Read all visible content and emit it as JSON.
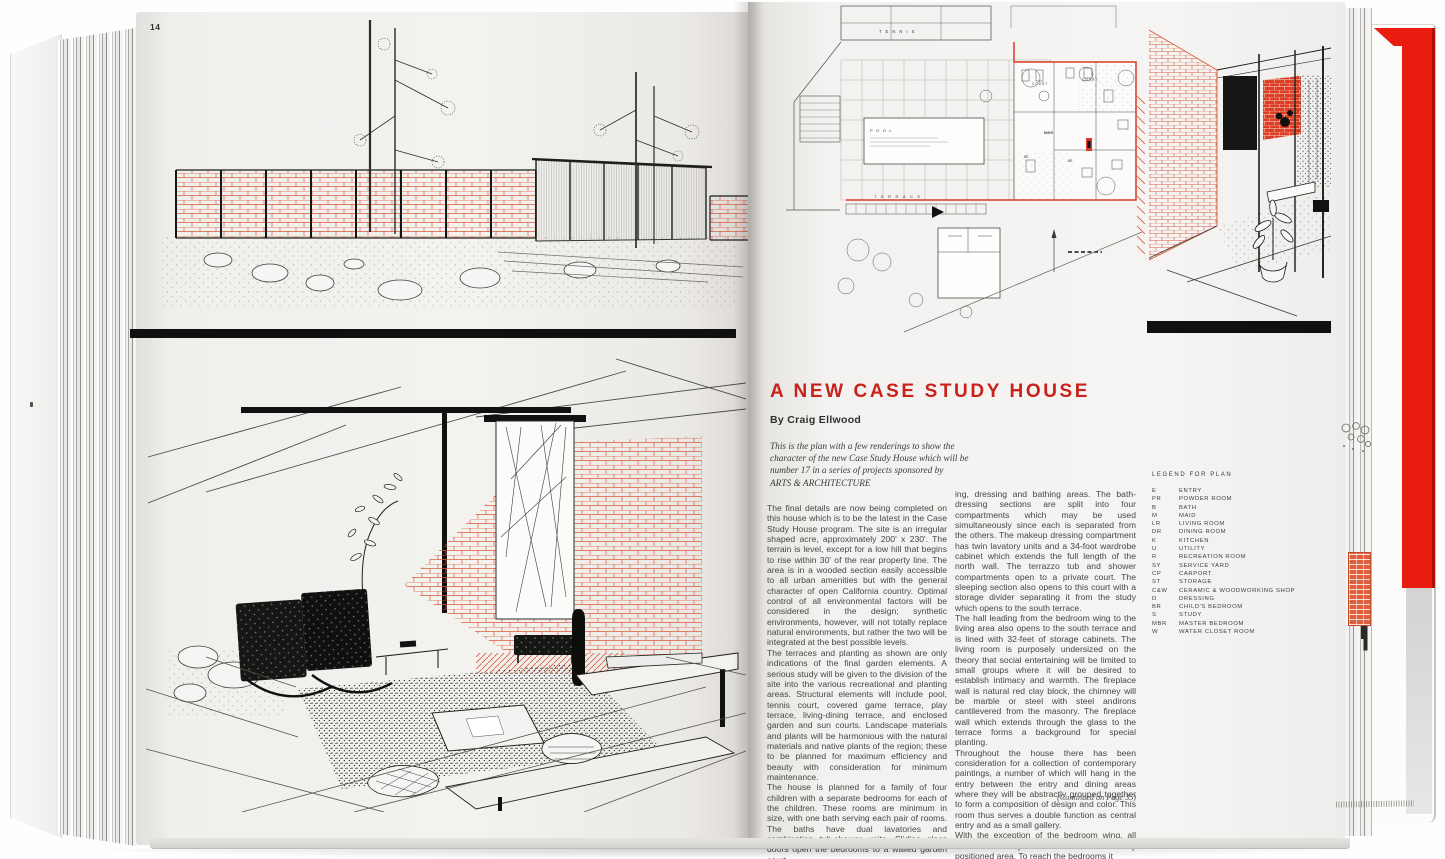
{
  "colors": {
    "accent_red": "#c8221b",
    "brick_red": "#d95b3b",
    "cover_red": "#e81d10"
  },
  "page_left": {
    "page_number": "14"
  },
  "article": {
    "title": "A NEW CASE STUDY HOUSE",
    "byline": "By Craig Ellwood",
    "intro": "This is the plan with a few renderings to show the\ncharacter of the new Case Study House which will be\nnumber 17 in a series of projects sponsored by\nARTS & ARCHITECTURE",
    "column1": [
      "The final details are now being completed on this house which is to be the latest in the Case Study House program. The site is an irregular shaped acre, approximately 200' x 230'. The terrain is level, except for a low hill that begins to rise within 30' of the rear property line. The area is in a wooded section easily accessible to all urban amenities but with the general character of open California country. Optimal control of all environmental factors will be considered in the design; synthetic environments, however, will not totally replace natural environments, but rather the two will be integrated at the best possible levels.",
      "The terraces and planting as shown are only indications of the final garden elements. A serious study will be given to the division of the site into the various recreational and planting areas. Structural elements will include pool, tennis court, covered game terrace, play terrace, living-dining terrace, and enclosed garden and sun courts. Landscape materials and plants will be harmonious with the natural materials and native plants of the region; these to be planned for maximum efficiency and beauty with consideration for minimum maintenance.",
      "The house is planned for a family of four children with a separate bedrooms for each of the children. These rooms are minimum in size, with one bath serving each pair of rooms. The baths have dual lavatories and combination tub-shower units. Sliding glass doors open the bedrooms to a walled garden court.",
      "The master bedroom wing includes study, sleep-"
    ],
    "column2": [
      "ing, dressing and bathing areas. The bath-dressing sections are split into four compartments which may be used simultaneously since each is separated from the others. The makeup dressing compartment has twin lavatory units and a 34-foot wardrobe cabinet which extends the full length of the north wall. The terrazzo tub and shower compartments open to a private court. The sleeping section also opens to this court with a storage divider separating it from the study which opens to the south terrace.",
      "The hall leading from the bedroom wing to the living area also opens to the south terrace and is lined with 32-feet of storage cabinets. The living room is purposely undersized on the theory that social entertaining will be limited to small groups where it will be desired to establish intimacy and warmth. The fireplace wall is natural red clay block, the chimney will be marble or steel with steel andirons cantilevered from the masonry. The fireplace wall which extends through the glass to the terrace forms a background for special planting.",
      "Throughout the house there has been consideration for a collection of contemporary paintings, a number of which will hang in the entry between the entry and dining areas where they will be abstractly grouped together to form a composition of design and color. This room thus serves a double function as central entry and as a small gallery.",
      "With the exception of the bedroom wing, all areas are directly accessible from this centrally positioned area. To reach the bedrooms it"
    ],
    "continued": "(Continued on Page 35)"
  },
  "plan": {
    "labels": {
      "tennis": "TENNIS",
      "pool": "POOL",
      "terrace": "TERRACE",
      "court1": "COURT",
      "court2": "COURT",
      "mbr": "MBR",
      "br1": "BR",
      "br2": "BR"
    }
  },
  "legend": {
    "title": "LEGEND FOR PLAN",
    "items": [
      {
        "abbr": "E",
        "label": "ENTRY"
      },
      {
        "abbr": "PR",
        "label": "POWDER ROOM"
      },
      {
        "abbr": "B",
        "label": "BATH"
      },
      {
        "abbr": "M",
        "label": "MAID"
      },
      {
        "abbr": "LR",
        "label": "LIVING ROOM"
      },
      {
        "abbr": "DR",
        "label": "DINING ROOM"
      },
      {
        "abbr": "K",
        "label": "KITCHEN"
      },
      {
        "abbr": "U",
        "label": "UTILITY"
      },
      {
        "abbr": "R",
        "label": "RECREATION ROOM"
      },
      {
        "abbr": "SY",
        "label": "SERVICE YARD"
      },
      {
        "abbr": "CP",
        "label": "CARPORT"
      },
      {
        "abbr": "ST",
        "label": "STORAGE"
      },
      {
        "abbr": "C&W",
        "label": "CERAMIC & WOODWORKING SHOP"
      },
      {
        "abbr": "D",
        "label": "DRESSING"
      },
      {
        "abbr": "BR",
        "label": "CHILD'S BEDROOM"
      },
      {
        "abbr": "S",
        "label": "STUDY"
      },
      {
        "abbr": "MBR",
        "label": "MASTER BEDROOM"
      },
      {
        "abbr": "W",
        "label": "WATER CLOSET ROOM"
      }
    ]
  }
}
